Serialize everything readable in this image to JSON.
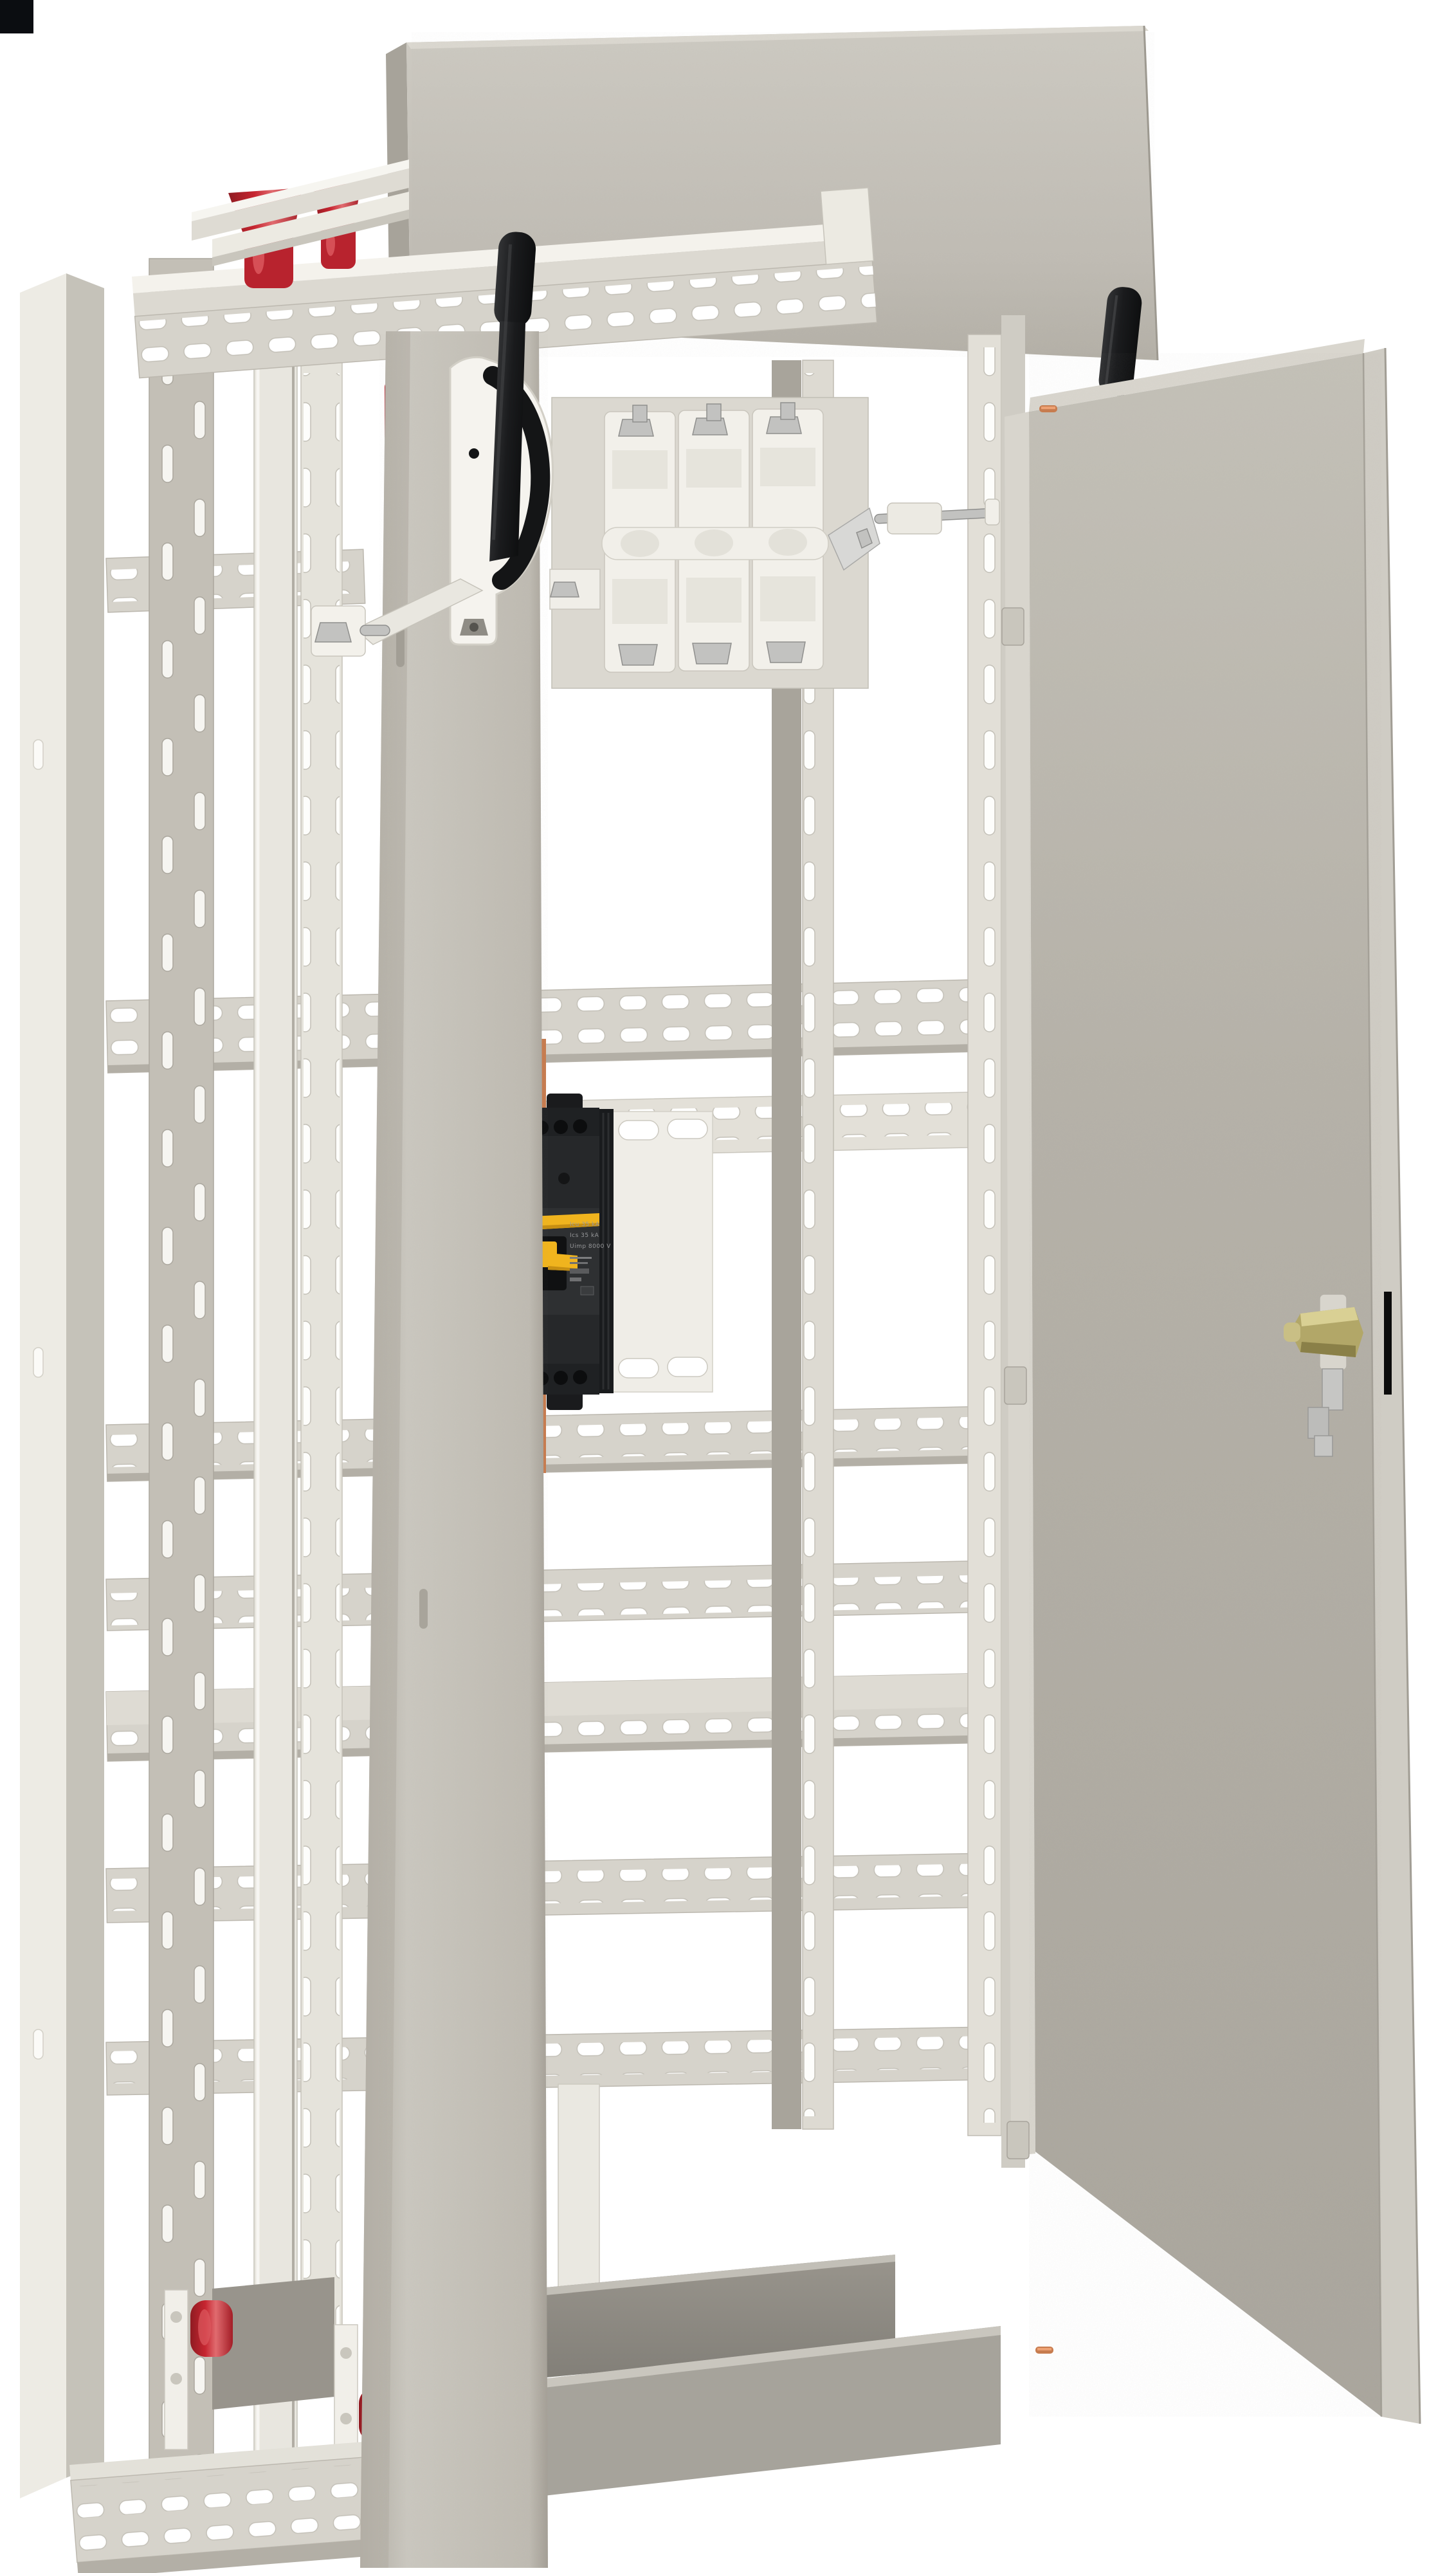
{
  "scene": {
    "title": "Electrical distribution cabinet 3D render",
    "description": "Open-frame floor-standing switchboard enclosure, light pebble-grey, right door open showing inner face, no visible floor shadow on white background",
    "background": "#ffffff",
    "corner_marker": "black calibration square, top-left"
  },
  "colors": {
    "red_insulator": "#b8232e",
    "red_highlight": "#dd5a60",
    "yellow_accent": "#f0b41e",
    "black_part": "#1b1c1e",
    "breaker_body": "#26282a",
    "breaker_side": "#1e2022",
    "copper": "#c77c4f",
    "copper_light": "#eda173",
    "brass": "#b2a768",
    "brass_light": "#d9d094",
    "steel_bolt": "#c2c2c0",
    "steel_white": "#f2f0ea",
    "steel_edge": "#c9c6bd",
    "rail_face": "#d6d3cb",
    "rail_edge": "#bcb8af",
    "rail_shadow": "#b3afa6",
    "panel_light": "#cbc8c0",
    "panel_dark": "#b2aea5",
    "post_face": "#c6c3ba",
    "dark_bay": "#a19d94",
    "tray_dark": "#8d8a83",
    "tray_mid": "#a6a39b"
  },
  "enclosure": {
    "frame": "open welded frame with perforated mounting rails and C-channels",
    "top_rear_panel": "large plain grey panel standing above frame",
    "left_posts": 2,
    "horizontal_perforated_rails": 9,
    "vertical_perforated_strips": 5,
    "bottom_tray": "dark grey L-shaped gland tray"
  },
  "door": {
    "state": "open, swung to the right, inner face visible",
    "texture": "powder-coat pebble texture",
    "hinge_count": 3,
    "copper_rivets": 2,
    "lock": {
      "type": "brass cylinder cam lock",
      "latch": "stepped steel latch bar",
      "keeper": "black strip on door fold"
    }
  },
  "main_switch": {
    "type": "3-pole switch-disconnector",
    "poles": 3,
    "shaft": "steel drive shaft to right-hand post",
    "operator": "black lever on white quadrant bracket, mounted on front-left post",
    "second_handle": "black lever tip visible above door top edge"
  },
  "breaker": {
    "type": "molded case circuit breaker, black, yellow toggle",
    "stripe": "yellow label stripe",
    "label_lines": [
      "Icu 35 kA",
      "Ics 35 kA",
      "Uimp 8000 V"
    ],
    "mounting": "bright perforated plate behind"
  },
  "busbar_supports": {
    "top_red_insulators": 3,
    "top_busbars": "two flat bars on edge above insulators",
    "bottom_red_insulators": 2,
    "bottom_brackets": "white angle brackets with round holes"
  }
}
